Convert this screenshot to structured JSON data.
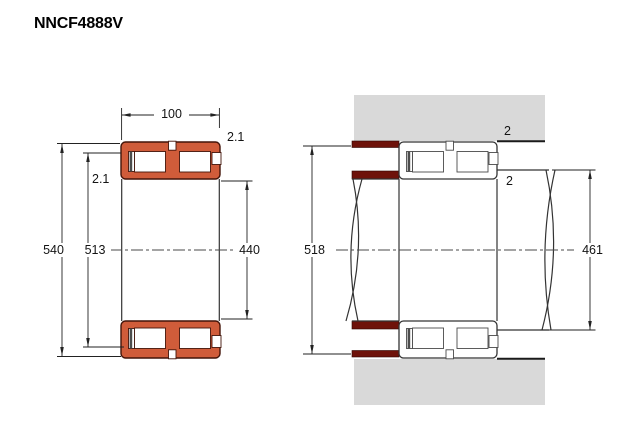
{
  "title": "NNCF4888V",
  "section_view": {
    "name": "bearing-cross-section-view",
    "dim_width": "100",
    "dim_outside_diameter": "540",
    "dim_raceway_diameter": "513",
    "dim_bore_diameter": "440",
    "chamfer_outer": "2.1",
    "chamfer_inner": "2.1"
  },
  "mounting_view": {
    "name": "mounting-abutment-view",
    "dim_housing_abutment_diameter": "518",
    "dim_shaft_abutment_diameter": "461",
    "fillet_housing": "2",
    "fillet_shaft": "2"
  },
  "colors": {
    "bearing_fill": "#d05c3a",
    "bearing_outline": "#431409",
    "abutment_ring": "#6e120a",
    "housing_gray": "#d9d9d9",
    "line": "#333333"
  }
}
